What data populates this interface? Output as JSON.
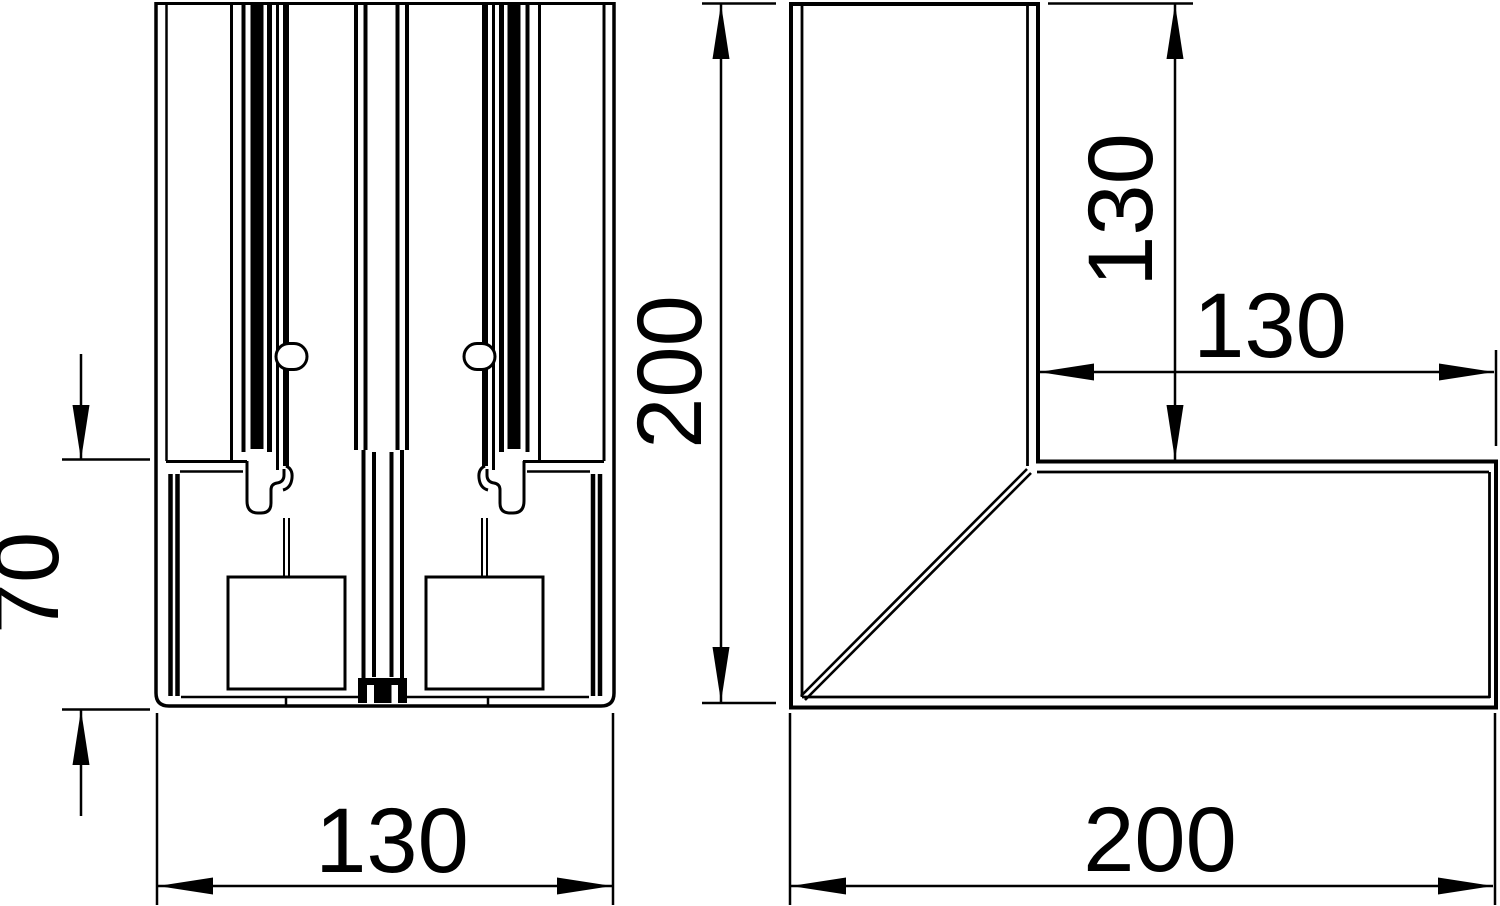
{
  "colors": {
    "ink": "#000000",
    "paper": "#ffffff"
  },
  "views": {
    "section": {
      "dim_depth": "70",
      "dim_width": "130"
    },
    "corner": {
      "dim_height": "200",
      "dim_leg_vertical": "130",
      "dim_leg_horizontal": "130",
      "dim_width": "200"
    }
  }
}
